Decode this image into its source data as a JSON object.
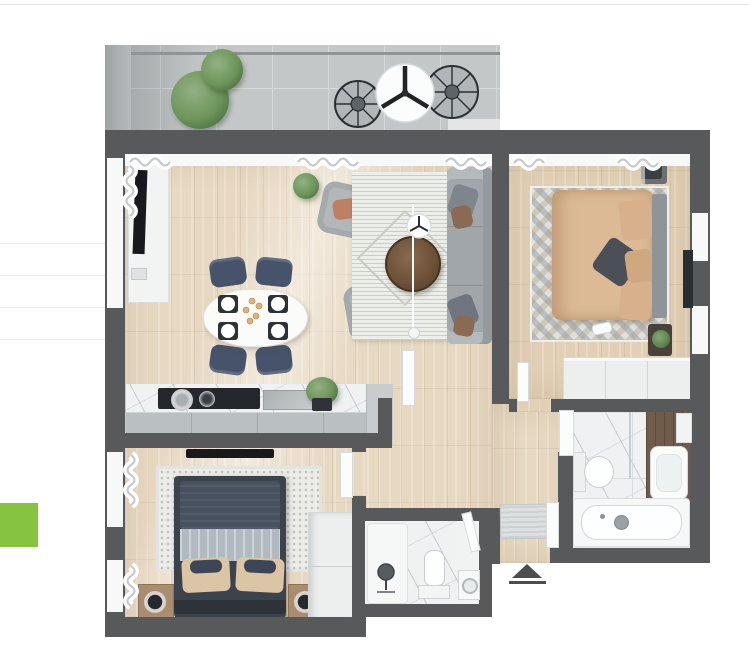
{
  "canvas": {
    "width": 749,
    "height": 669
  },
  "colors": {
    "background": "#ffffff",
    "topline": "#e4e4e4",
    "rowline": "#ececec",
    "green": "#85c340",
    "wall": "#58595b",
    "wood": "#e7d8c1",
    "wood2": "#e2d0b6",
    "balcony": "#c3c7c8",
    "balcony-grid": "#d5d8d9",
    "white": "#f7f8f8",
    "sofa": "#a0a6a9",
    "navy": "#46536a",
    "beige": "#dcba96",
    "bednavy": "#47515f",
    "salmon": "#bf7f63",
    "plantgreen": "#5f8650",
    "marble": "#eff1f2",
    "darkwood": "#6f5c4a",
    "dark": "#17191c",
    "cabinet": "#babfc1",
    "triangle": "#4b4e51"
  },
  "left_rail": {
    "divider_count": 4,
    "divider_ys": [
      243,
      275,
      307,
      339
    ],
    "green_button": {
      "x": 0,
      "y": 503,
      "width": 38,
      "height": 44
    }
  },
  "floor_plan": {
    "type": "apartment-top-view-render",
    "rooms": [
      "balcony",
      "living-room",
      "dining-area",
      "kitchen",
      "bedroom-primary",
      "bedroom-second",
      "bathroom-main",
      "bathroom-small",
      "hallway",
      "entrance"
    ],
    "furniture": [
      "balcony-plants",
      "balcony-wire-chairs",
      "balcony-round-table",
      "tv-console",
      "wall-tv",
      "dining-table",
      "dining-chairs",
      "area-rug",
      "coffee-table",
      "side-table",
      "floor-lamp",
      "sofa",
      "armchairs",
      "kitchen-counter",
      "cooktop",
      "kitchen-sink",
      "kitchen-cabinets",
      "bed-primary",
      "zigzag-rug",
      "wardrobe",
      "bed-second",
      "dotted-rug",
      "nightstands",
      "lamps",
      "wardrobe-2",
      "shower",
      "toilet",
      "washing-machine",
      "bathtub",
      "vanity-sink",
      "doormat",
      "door-leaves"
    ],
    "entrance_marker": "triangle-up"
  }
}
